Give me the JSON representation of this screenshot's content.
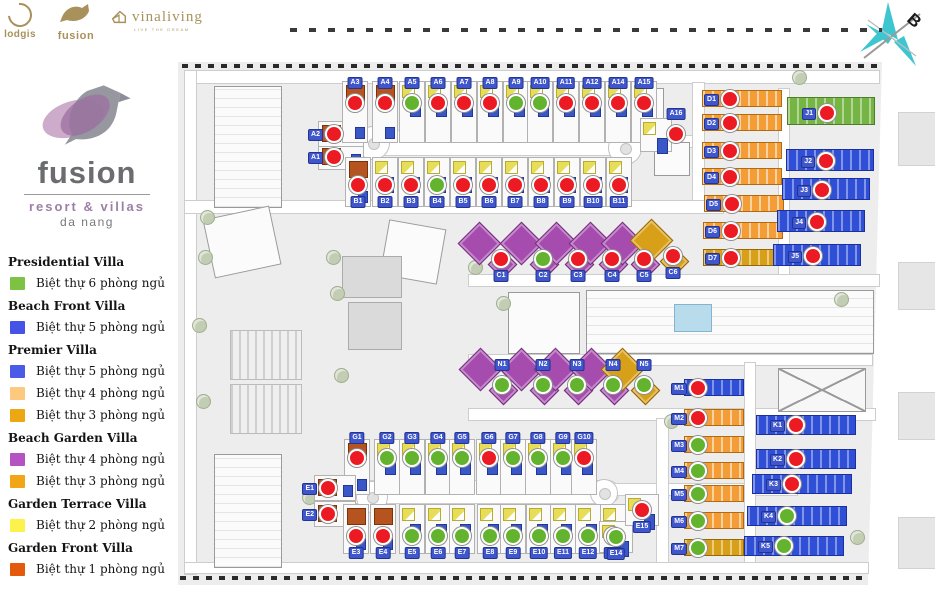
{
  "header": {
    "logos": [
      {
        "name": "lodgis",
        "label": "lodgis"
      },
      {
        "name": "fusion",
        "label": "fusion"
      },
      {
        "name": "vinaliving",
        "label": "vinaliving",
        "tagline": "LIVE THE DREAM"
      }
    ],
    "compass_letter": "B"
  },
  "brand": {
    "name": "fusion",
    "subtitle": "resort & villas",
    "location": "da nang"
  },
  "legend": {
    "groups": [
      {
        "title": "Presidential Villa",
        "items": [
          {
            "color": "#7dc242",
            "label": "Biệt thự 6 phòng ngủ"
          }
        ]
      },
      {
        "title": "Beach Front Villa",
        "items": [
          {
            "color": "#4553e6",
            "label": "Biệt thự 5 phòng ngủ"
          }
        ]
      },
      {
        "title": "Premier Villa",
        "items": [
          {
            "color": "#4a5be8",
            "label": "Biệt thự 5 phòng ngủ"
          },
          {
            "color": "#fdc97e",
            "label": "Biệt thự 4 phòng ngủ"
          },
          {
            "color": "#eda712",
            "label": "Biệt thự 3 phòng ngủ"
          }
        ]
      },
      {
        "title": "Beach Garden Villa",
        "items": [
          {
            "color": "#b553c3",
            "label": "Biệt thự 4 phòng ngủ"
          },
          {
            "color": "#f2a517",
            "label": "Biệt thự 3 phòng ngủ"
          }
        ]
      },
      {
        "title": "Garden Terrace Villa",
        "items": [
          {
            "color": "#fdf24b",
            "label": "Biệt thự 2 phòng ngủ"
          }
        ]
      },
      {
        "title": "Garden Front Villa",
        "items": [
          {
            "color": "#e35a0c",
            "label": "Biệt thự 1 phòng ngủ"
          }
        ]
      }
    ]
  },
  "map": {
    "status_colors": {
      "sold": "#ec1b23",
      "available": "#64b32e"
    },
    "lots": [
      {
        "id": "A1",
        "x": 156,
        "y": 95,
        "status": "sold",
        "row": "AL",
        "roof": "terra",
        "label": "left"
      },
      {
        "id": "A2",
        "x": 156,
        "y": 72,
        "status": "sold",
        "row": "AL",
        "roof": "terra",
        "label": "left"
      },
      {
        "id": "A3",
        "x": 177,
        "y": 41,
        "status": "sold",
        "row": "A",
        "roof": "terra",
        "label": "top"
      },
      {
        "id": "A4",
        "x": 207,
        "y": 41,
        "status": "sold",
        "row": "A",
        "roof": "terra",
        "label": "top"
      },
      {
        "id": "A5",
        "x": 234,
        "y": 41,
        "status": "available",
        "row": "A",
        "roof": "yb",
        "label": "top"
      },
      {
        "id": "A6",
        "x": 260,
        "y": 41,
        "status": "sold",
        "row": "A",
        "roof": "yb",
        "label": "top"
      },
      {
        "id": "A7",
        "x": 286,
        "y": 41,
        "status": "sold",
        "row": "A",
        "roof": "yb",
        "label": "top"
      },
      {
        "id": "A8",
        "x": 312,
        "y": 41,
        "status": "sold",
        "row": "A",
        "roof": "yb",
        "label": "top"
      },
      {
        "id": "A9",
        "x": 338,
        "y": 41,
        "status": "available",
        "row": "A",
        "roof": "yb",
        "label": "top"
      },
      {
        "id": "A10",
        "x": 362,
        "y": 41,
        "status": "available",
        "row": "A",
        "roof": "yb",
        "label": "top"
      },
      {
        "id": "A11",
        "x": 388,
        "y": 41,
        "status": "sold",
        "row": "A",
        "roof": "yb",
        "label": "top"
      },
      {
        "id": "A12",
        "x": 414,
        "y": 41,
        "status": "sold",
        "row": "A",
        "roof": "yb",
        "label": "top"
      },
      {
        "id": "A14",
        "x": 440,
        "y": 41,
        "status": "sold",
        "row": "A",
        "roof": "yb",
        "label": "top"
      },
      {
        "id": "A15",
        "x": 466,
        "y": 41,
        "status": "sold",
        "row": "A",
        "roof": "yb",
        "label": "top"
      },
      {
        "id": "A16",
        "x": 498,
        "y": 72,
        "status": "sold",
        "row": "A16",
        "roof": "yb",
        "label": "top"
      },
      {
        "id": "B1",
        "x": 180,
        "y": 123,
        "status": "sold",
        "row": "B",
        "roof": "terra",
        "label": "bottom"
      },
      {
        "id": "B2",
        "x": 207,
        "y": 123,
        "status": "sold",
        "row": "B",
        "roof": "yb",
        "label": "bottom"
      },
      {
        "id": "B3",
        "x": 233,
        "y": 123,
        "status": "sold",
        "row": "B",
        "roof": "yb",
        "label": "bottom"
      },
      {
        "id": "B4",
        "x": 259,
        "y": 123,
        "status": "available",
        "row": "B",
        "roof": "yb",
        "label": "bottom"
      },
      {
        "id": "B5",
        "x": 285,
        "y": 123,
        "status": "sold",
        "row": "B",
        "roof": "yb",
        "label": "bottom"
      },
      {
        "id": "B6",
        "x": 311,
        "y": 123,
        "status": "sold",
        "row": "B",
        "roof": "yb",
        "label": "bottom"
      },
      {
        "id": "B7",
        "x": 337,
        "y": 123,
        "status": "sold",
        "row": "B",
        "roof": "yb",
        "label": "bottom"
      },
      {
        "id": "B8",
        "x": 363,
        "y": 123,
        "status": "sold",
        "row": "B",
        "roof": "yb",
        "label": "bottom"
      },
      {
        "id": "B9",
        "x": 389,
        "y": 123,
        "status": "sold",
        "row": "B",
        "roof": "yb",
        "label": "bottom"
      },
      {
        "id": "B10",
        "x": 415,
        "y": 123,
        "status": "sold",
        "row": "B",
        "roof": "yb",
        "label": "bottom"
      },
      {
        "id": "B11",
        "x": 441,
        "y": 123,
        "status": "sold",
        "row": "B",
        "roof": "yb",
        "label": "bottom"
      },
      {
        "id": "C1",
        "x": 323,
        "y": 197,
        "status": "sold",
        "row": "C",
        "roof": "dpurple",
        "label": "bottom"
      },
      {
        "id": "C2",
        "x": 365,
        "y": 197,
        "status": "available",
        "row": "C",
        "roof": "dpurple",
        "label": "bottom"
      },
      {
        "id": "C3",
        "x": 400,
        "y": 197,
        "status": "sold",
        "row": "C",
        "roof": "dpurple",
        "label": "bottom"
      },
      {
        "id": "C4",
        "x": 434,
        "y": 197,
        "status": "sold",
        "row": "C",
        "roof": "dpurple",
        "label": "bottom"
      },
      {
        "id": "C5",
        "x": 466,
        "y": 197,
        "status": "sold",
        "row": "C",
        "roof": "dpurple",
        "label": "bottom"
      },
      {
        "id": "C6",
        "x": 495,
        "y": 194,
        "status": "sold",
        "row": "C",
        "roof": "dgold",
        "label": "bottom"
      },
      {
        "id": "D1",
        "x": 552,
        "y": 37,
        "status": "sold",
        "row": "D",
        "roof": "oband",
        "label": "left"
      },
      {
        "id": "D2",
        "x": 552,
        "y": 61,
        "status": "sold",
        "row": "D",
        "roof": "oband",
        "label": "left"
      },
      {
        "id": "D3",
        "x": 552,
        "y": 89,
        "status": "sold",
        "row": "D",
        "roof": "oband",
        "label": "left"
      },
      {
        "id": "D4",
        "x": 552,
        "y": 115,
        "status": "sold",
        "row": "D",
        "roof": "oband",
        "label": "left"
      },
      {
        "id": "D5",
        "x": 554,
        "y": 142,
        "status": "sold",
        "row": "D",
        "roof": "oband",
        "label": "left"
      },
      {
        "id": "D6",
        "x": 553,
        "y": 169,
        "status": "sold",
        "row": "D",
        "roof": "oband",
        "label": "left"
      },
      {
        "id": "D7",
        "x": 553,
        "y": 196,
        "status": "sold",
        "row": "D",
        "roof": "goldband",
        "label": "left"
      },
      {
        "id": "J1",
        "x": 649,
        "y": 51,
        "status": "sold",
        "row": "J",
        "roof": "gband",
        "label": "left"
      },
      {
        "id": "J2",
        "x": 648,
        "y": 99,
        "status": "sold",
        "row": "J",
        "roof": "bband",
        "label": "left"
      },
      {
        "id": "J3",
        "x": 644,
        "y": 128,
        "status": "sold",
        "row": "J",
        "roof": "bband",
        "label": "left"
      },
      {
        "id": "J4",
        "x": 639,
        "y": 160,
        "status": "sold",
        "row": "J",
        "roof": "bband",
        "label": "left"
      },
      {
        "id": "J5",
        "x": 635,
        "y": 194,
        "status": "sold",
        "row": "J",
        "roof": "bband",
        "label": "left"
      },
      {
        "id": "N1",
        "x": 324,
        "y": 323,
        "status": "available",
        "row": "N",
        "roof": "dpurple",
        "label": "top"
      },
      {
        "id": "N2",
        "x": 365,
        "y": 323,
        "status": "available",
        "row": "N",
        "roof": "dpurple",
        "label": "top"
      },
      {
        "id": "N3",
        "x": 399,
        "y": 323,
        "status": "available",
        "row": "N",
        "roof": "dpurple",
        "label": "top"
      },
      {
        "id": "N4",
        "x": 435,
        "y": 323,
        "status": "available",
        "row": "N",
        "roof": "dpurple",
        "label": "top"
      },
      {
        "id": "N5",
        "x": 466,
        "y": 323,
        "status": "available",
        "row": "N",
        "roof": "dgold",
        "label": "top"
      },
      {
        "id": "G1",
        "x": 179,
        "y": 396,
        "status": "sold",
        "row": "G",
        "roof": "terra",
        "label": "top"
      },
      {
        "id": "G2",
        "x": 209,
        "y": 396,
        "status": "available",
        "row": "G",
        "roof": "yb",
        "label": "top"
      },
      {
        "id": "G3",
        "x": 234,
        "y": 396,
        "status": "available",
        "row": "G",
        "roof": "yb",
        "label": "top"
      },
      {
        "id": "G4",
        "x": 260,
        "y": 396,
        "status": "available",
        "row": "G",
        "roof": "yb",
        "label": "top"
      },
      {
        "id": "G5",
        "x": 284,
        "y": 396,
        "status": "available",
        "row": "G",
        "roof": "yb",
        "label": "top"
      },
      {
        "id": "G6",
        "x": 311,
        "y": 396,
        "status": "sold",
        "row": "G",
        "roof": "yb",
        "label": "top"
      },
      {
        "id": "G7",
        "x": 335,
        "y": 396,
        "status": "available",
        "row": "G",
        "roof": "yb",
        "label": "top"
      },
      {
        "id": "G8",
        "x": 360,
        "y": 396,
        "status": "available",
        "row": "G",
        "roof": "yb",
        "label": "top"
      },
      {
        "id": "G9",
        "x": 385,
        "y": 396,
        "status": "available",
        "row": "G",
        "roof": "yb",
        "label": "top"
      },
      {
        "id": "G10",
        "x": 406,
        "y": 396,
        "status": "sold",
        "row": "G",
        "roof": "yb",
        "label": "top"
      },
      {
        "id": "E1",
        "x": 150,
        "y": 426,
        "status": "sold",
        "row": "EL",
        "roof": "terra",
        "label": "left"
      },
      {
        "id": "E2",
        "x": 150,
        "y": 452,
        "status": "sold",
        "row": "EL",
        "roof": "terra",
        "label": "left"
      },
      {
        "id": "E3",
        "x": 178,
        "y": 474,
        "status": "sold",
        "row": "E",
        "roof": "terra",
        "label": "bottom"
      },
      {
        "id": "E4",
        "x": 205,
        "y": 474,
        "status": "sold",
        "row": "E",
        "roof": "terra",
        "label": "bottom"
      },
      {
        "id": "E5",
        "x": 234,
        "y": 474,
        "status": "available",
        "row": "E",
        "roof": "yb",
        "label": "bottom"
      },
      {
        "id": "E6",
        "x": 260,
        "y": 474,
        "status": "available",
        "row": "E",
        "roof": "yb",
        "label": "bottom"
      },
      {
        "id": "E7",
        "x": 284,
        "y": 474,
        "status": "available",
        "row": "E",
        "roof": "yb",
        "label": "bottom"
      },
      {
        "id": "E8",
        "x": 312,
        "y": 474,
        "status": "available",
        "row": "E",
        "roof": "yb",
        "label": "bottom"
      },
      {
        "id": "E9",
        "x": 335,
        "y": 474,
        "status": "available",
        "row": "E",
        "roof": "yb",
        "label": "bottom"
      },
      {
        "id": "E10",
        "x": 361,
        "y": 474,
        "status": "available",
        "row": "E",
        "roof": "yb",
        "label": "bottom"
      },
      {
        "id": "E11",
        "x": 385,
        "y": 474,
        "status": "available",
        "row": "E",
        "roof": "yb",
        "label": "bottom"
      },
      {
        "id": "E12",
        "x": 410,
        "y": 474,
        "status": "available",
        "row": "E",
        "roof": "yb",
        "label": "bottom"
      },
      {
        "id": "E13",
        "x": 435,
        "y": 474,
        "status": "available",
        "row": "E",
        "roof": "yb",
        "label": "bottom"
      },
      {
        "id": "E14",
        "x": 438,
        "y": 475,
        "status": "available",
        "row": "EC",
        "roof": "yb",
        "label": "bottom"
      },
      {
        "id": "E15",
        "x": 464,
        "y": 448,
        "status": "sold",
        "row": "EC",
        "roof": "yb",
        "label": "bottom"
      },
      {
        "id": "M1",
        "x": 520,
        "y": 326,
        "status": "sold",
        "row": "M",
        "roof": "bband",
        "label": "left"
      },
      {
        "id": "M2",
        "x": 520,
        "y": 356,
        "status": "sold",
        "row": "M",
        "roof": "oband",
        "label": "left"
      },
      {
        "id": "M3",
        "x": 520,
        "y": 383,
        "status": "available",
        "row": "M",
        "roof": "oband",
        "label": "left"
      },
      {
        "id": "M4",
        "x": 520,
        "y": 409,
        "status": "available",
        "row": "M",
        "roof": "oband",
        "label": "left"
      },
      {
        "id": "M5",
        "x": 520,
        "y": 432,
        "status": "available",
        "row": "M",
        "roof": "oband",
        "label": "left"
      },
      {
        "id": "M6",
        "x": 520,
        "y": 459,
        "status": "available",
        "row": "M",
        "roof": "oband",
        "label": "left"
      },
      {
        "id": "M7",
        "x": 520,
        "y": 486,
        "status": "available",
        "row": "M",
        "roof": "goldband",
        "label": "left"
      },
      {
        "id": "K1",
        "x": 618,
        "y": 363,
        "status": "sold",
        "row": "K",
        "roof": "bband",
        "label": "left"
      },
      {
        "id": "K2",
        "x": 618,
        "y": 397,
        "status": "sold",
        "row": "K",
        "roof": "bband",
        "label": "left"
      },
      {
        "id": "K3",
        "x": 614,
        "y": 422,
        "status": "sold",
        "row": "K",
        "roof": "bband",
        "label": "left"
      },
      {
        "id": "K4",
        "x": 609,
        "y": 454,
        "status": "available",
        "row": "K",
        "roof": "bband",
        "label": "left"
      },
      {
        "id": "K5",
        "x": 606,
        "y": 484,
        "status": "available",
        "row": "K",
        "roof": "bband",
        "label": "left"
      }
    ]
  }
}
